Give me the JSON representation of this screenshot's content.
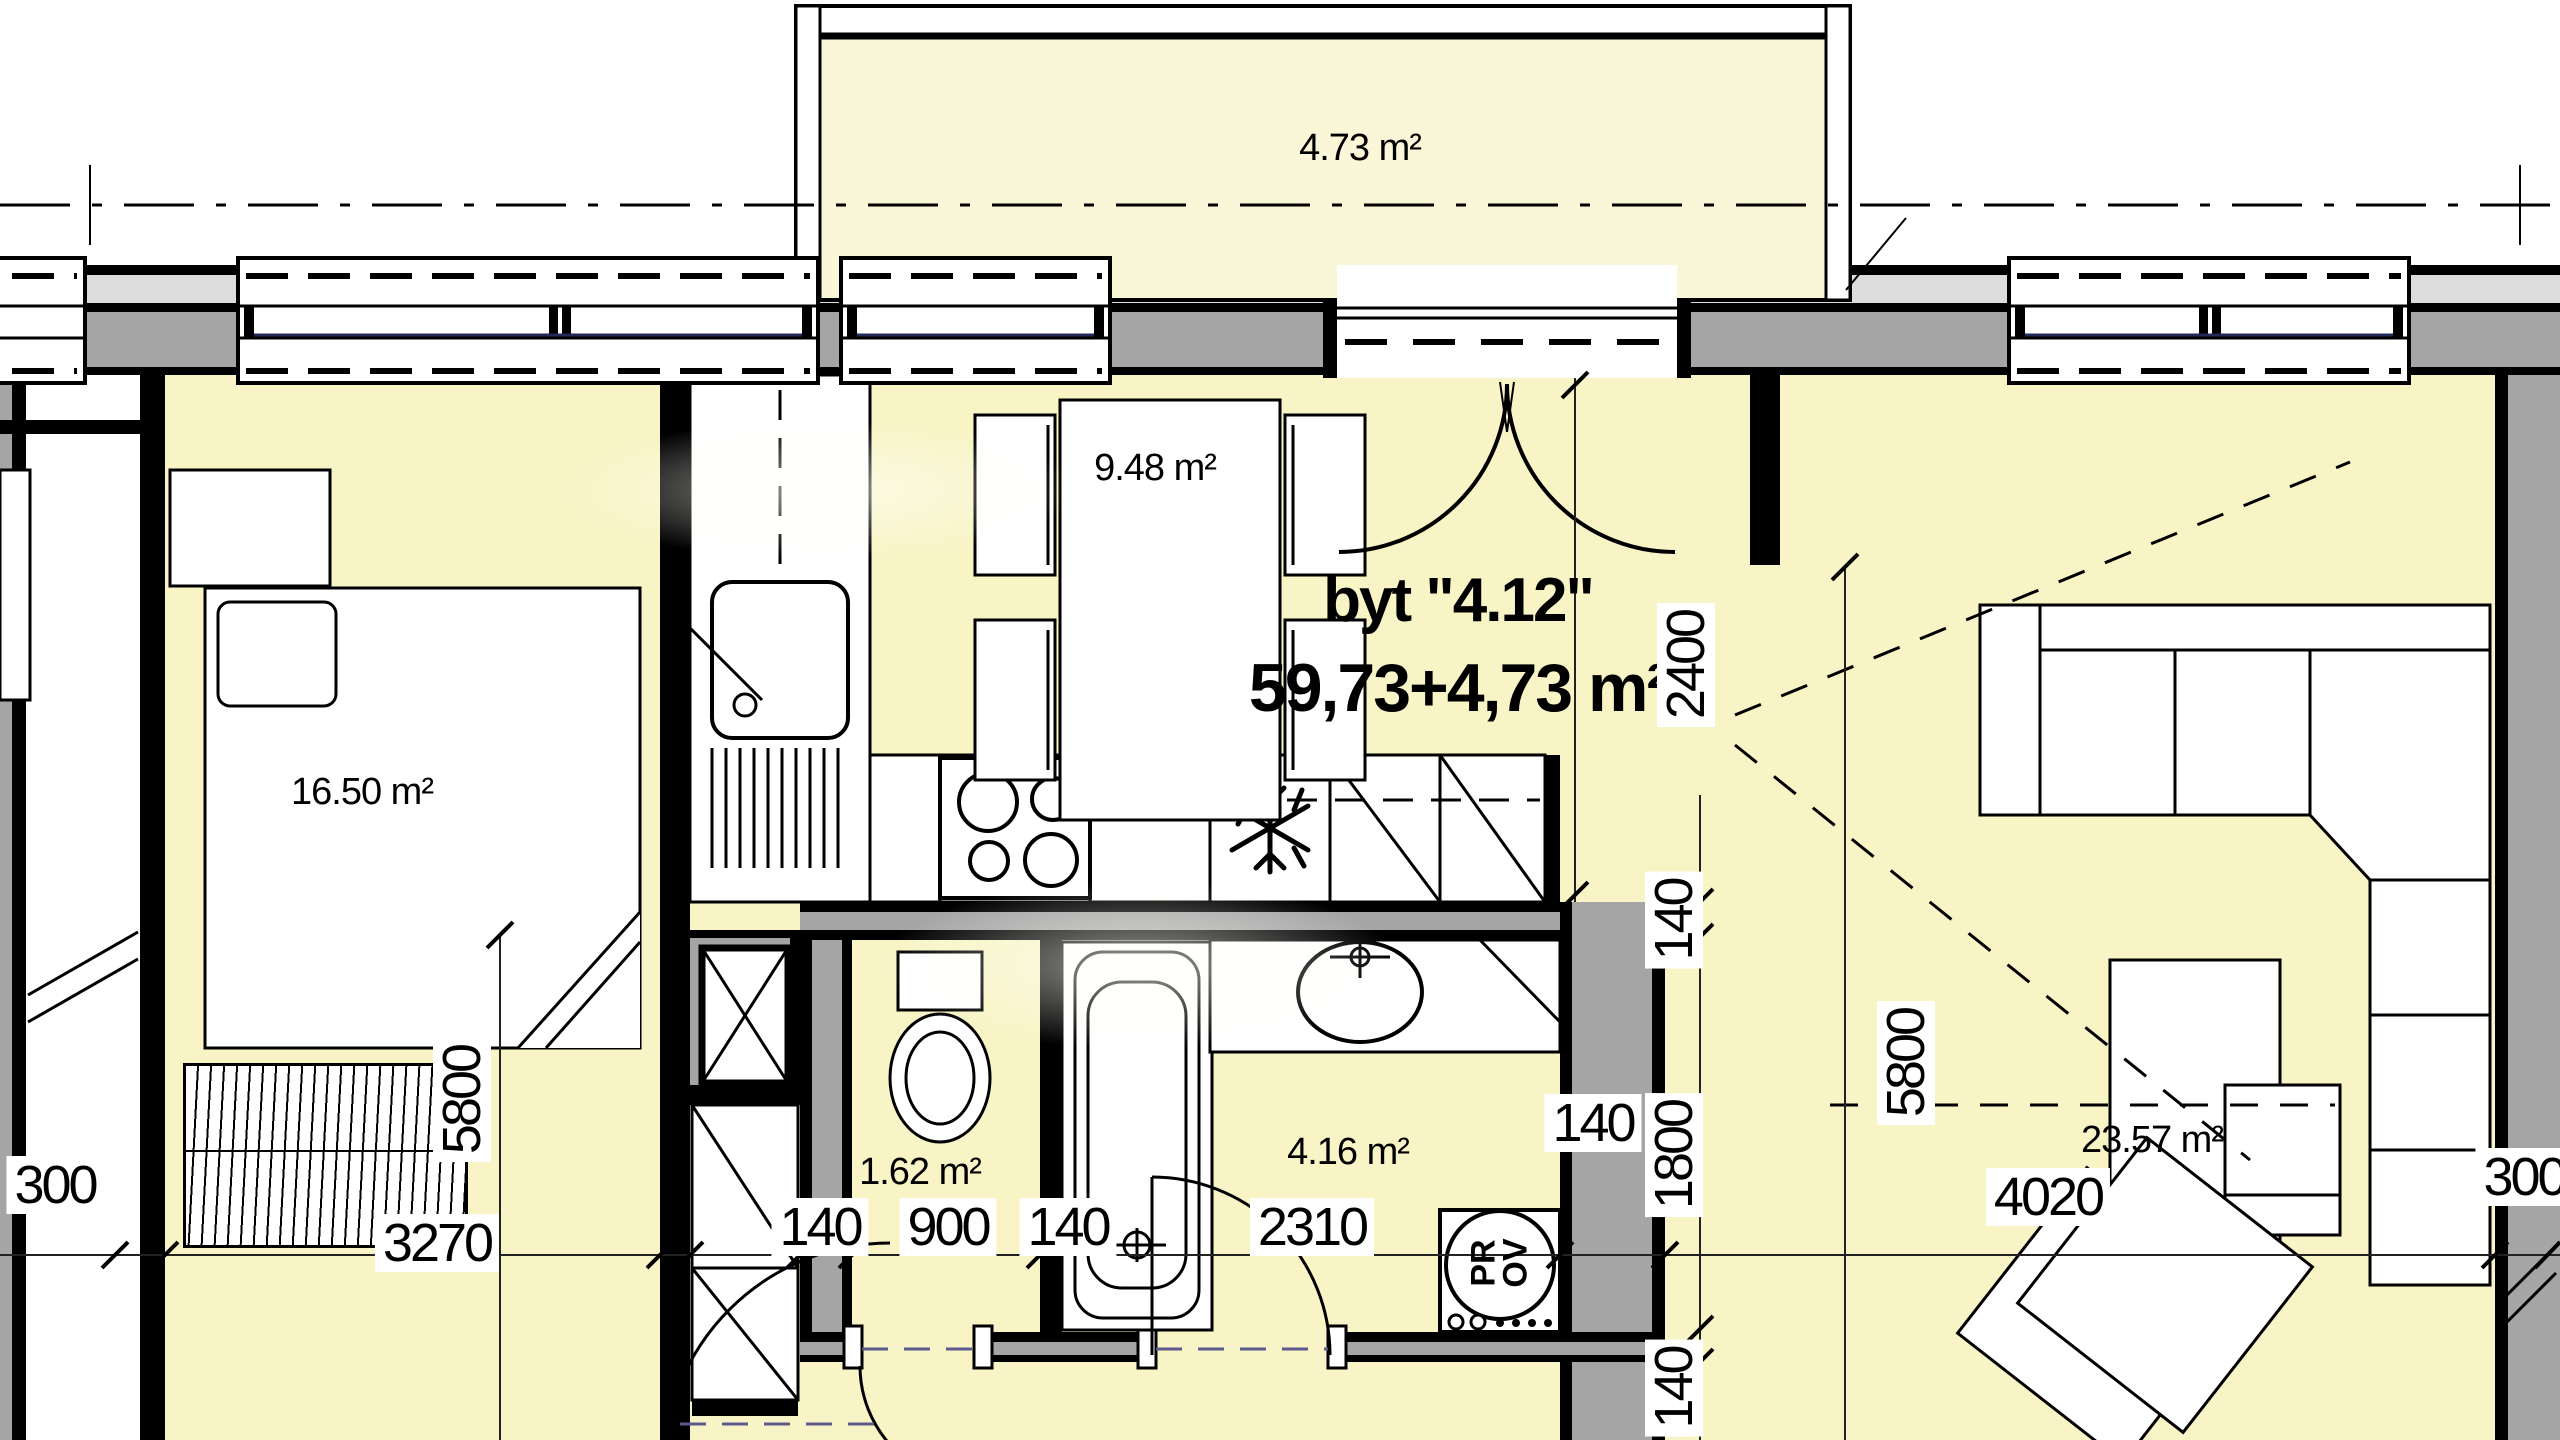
{
  "drawing": {
    "title_line1": "byt \"4.12\"",
    "title_line2": "59,73+4,73 m²",
    "rooms": {
      "balcony": {
        "area": "4.73 m²"
      },
      "bedroom": {
        "area": "16.50 m²"
      },
      "kitchen_dining": {
        "area": "9.48 m²"
      },
      "wc": {
        "area": "1.62 m²"
      },
      "bathroom": {
        "area": "4.16 m²"
      },
      "living": {
        "area": "23.57 m²"
      }
    },
    "dimensions": {
      "horizontal_chain": [
        "300",
        "3270",
        "140",
        "900",
        "140",
        "2310",
        "140",
        "4020",
        "300"
      ],
      "bedroom_depth": "5800",
      "kitchen_depth": "2400",
      "bath_chain": [
        "140",
        "1800",
        "140"
      ],
      "living_depth": "5800"
    },
    "appliances": {
      "washer_line1": "PR",
      "washer_line2": "OV",
      "sink_symbol": "ø"
    },
    "colors": {
      "room_fill": "#F8F4C6",
      "balcony_fill": "#FAF7D8",
      "wall_gray": "#A5A5A5",
      "facade_light": "#DCDCDC",
      "line_black": "#000000"
    }
  }
}
